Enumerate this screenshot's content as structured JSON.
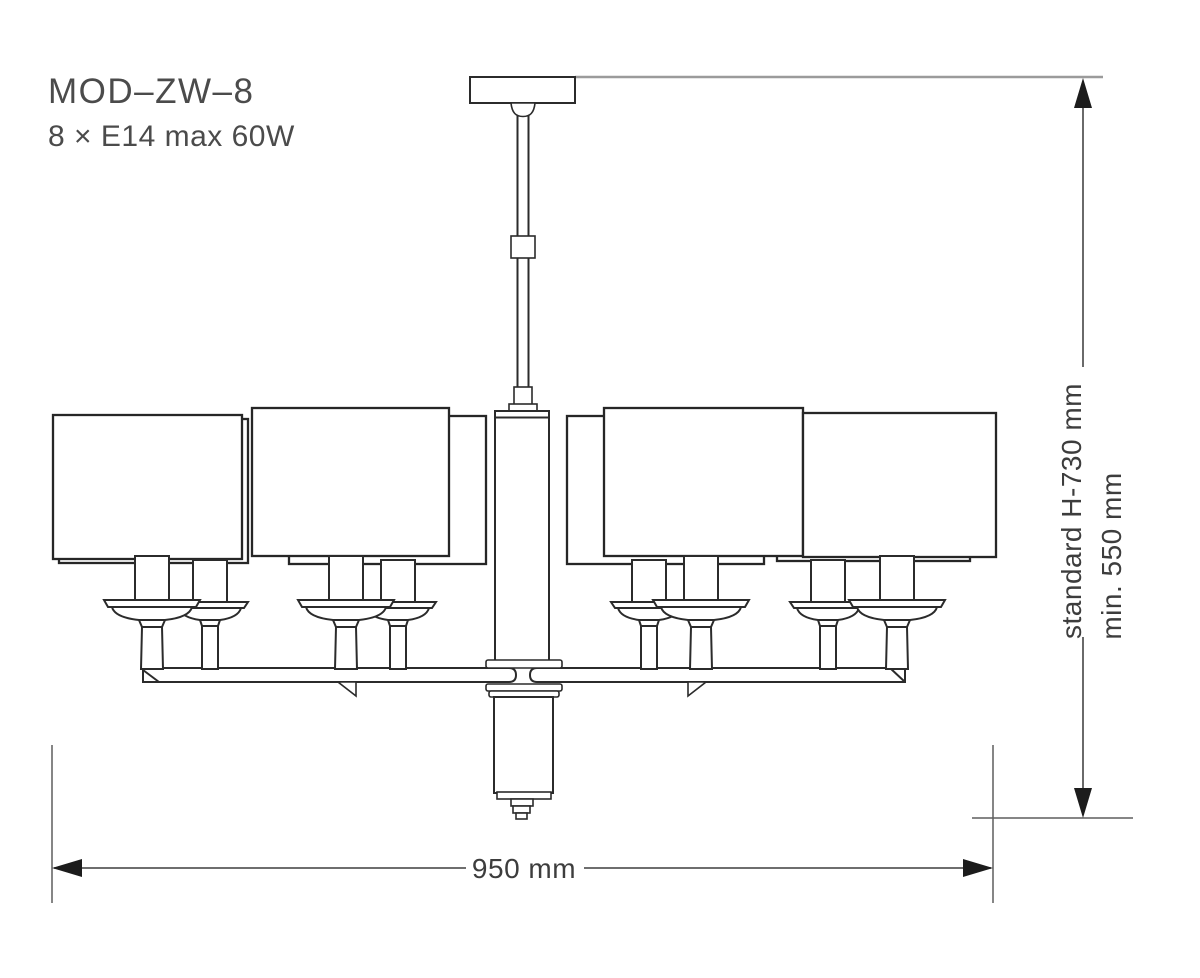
{
  "title_block": {
    "model": "MOD–ZW–8",
    "lamp_spec": "8 × E14 max 60W"
  },
  "dimensions": {
    "width": "950 mm",
    "height_standard": "standard H-730 mm",
    "height_min": "min. 550 mm"
  },
  "drawing": {
    "subject": "chandelier technical line drawing",
    "shade_count": 8,
    "socket_type": "E14",
    "max_wattage": "60W",
    "colors": {
      "background": "#ffffff",
      "line": "#2b2b2b",
      "dimension_line": "#5a5a5a",
      "extension_line": "#9b9b9b",
      "arrow": "#1c1c1c",
      "text": "#474747"
    }
  }
}
